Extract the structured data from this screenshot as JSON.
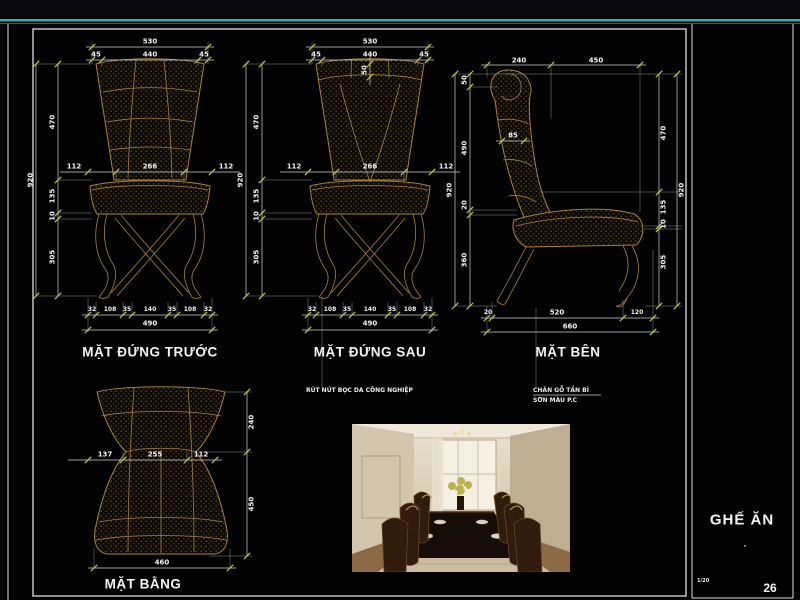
{
  "sheet": {
    "page_number": "26",
    "scale": "1/20"
  },
  "right_panel": {
    "title": "GHẾ ĂN",
    "dot": "."
  },
  "views": {
    "front": {
      "title": "MẶT ĐỨNG TRƯỚC",
      "dim_total_width": "530",
      "dim_top": [
        "45",
        "440",
        "45"
      ],
      "dim_mid": [
        "112",
        "266",
        "112"
      ],
      "dim_left": [
        "470",
        "135",
        "10",
        "305"
      ],
      "dim_height_total": "920",
      "dim_bottom": [
        "32",
        "108",
        "35",
        "140",
        "35",
        "108",
        "32"
      ],
      "dim_bottom_total": "490"
    },
    "back": {
      "title": "MẶT ĐỨNG SAU",
      "dim_total_width": "530",
      "dim_top": [
        "45",
        "440",
        "45"
      ],
      "dim_top_rail": "50",
      "dim_mid": [
        "112",
        "266",
        "112"
      ],
      "dim_left": [
        "470",
        "135",
        "10",
        "305"
      ],
      "dim_height_total": "920",
      "dim_bottom": [
        "32",
        "108",
        "35",
        "140",
        "35",
        "108",
        "32"
      ],
      "dim_bottom_total": "490",
      "note": "RÚT NÚT BỌC DA CÔNG NGHIỆP"
    },
    "side": {
      "title": "MẶT BÊN",
      "dim_top": [
        "240",
        "450"
      ],
      "dim_left": [
        "50",
        "490",
        "20",
        "360"
      ],
      "dim_right": [
        "470",
        "135",
        "10",
        "305"
      ],
      "dim_height_total": "920",
      "dim_back_thickness": "85",
      "dim_bottom": [
        "20",
        "520",
        "120"
      ],
      "dim_bottom_total": "660",
      "notes": [
        "CHÂN GỖ TẦN BÌ",
        "SƠN MÀU P.C"
      ]
    },
    "plan": {
      "title": "MẶT BẰNG",
      "dim_mid": [
        "137",
        "255",
        "112"
      ],
      "dim_right": [
        "240",
        "450"
      ],
      "dim_bottom_total": "460"
    }
  },
  "colors": {
    "accent_teal": "#27b7b3",
    "chair_outline": "#a5803f",
    "tick_green": "#b9c94b",
    "dim_line": "#d0d0d0"
  }
}
